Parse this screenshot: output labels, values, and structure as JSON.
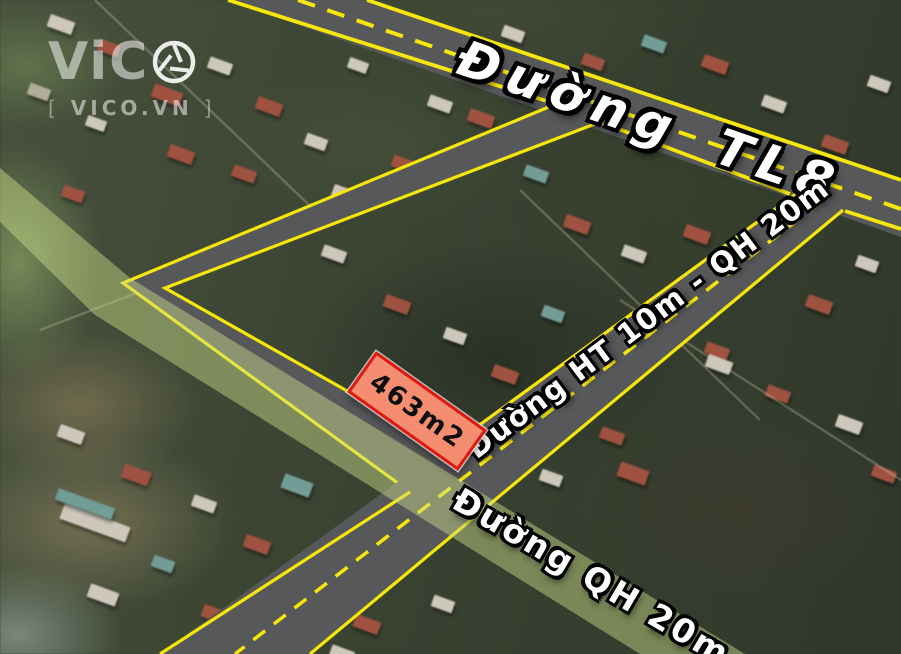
{
  "watermark": {
    "brand": "ViC",
    "icon": "aperture-o-icon",
    "domain": "VICO.VN",
    "bracket_left": "[",
    "bracket_right": "]"
  },
  "roads": {
    "tl8_label": "Đường TL8",
    "ht_label": "Đường HT 10m - QH 20m",
    "qh_label": "Đường QH 20m"
  },
  "plot": {
    "area_label": "463m2"
  },
  "colors": {
    "road_fill": "#57585a",
    "line_yellow": "#f6e60a",
    "corridor_green": "#cfe08a",
    "plot_fill": "#f58e71",
    "plot_border": "#e3170d"
  }
}
